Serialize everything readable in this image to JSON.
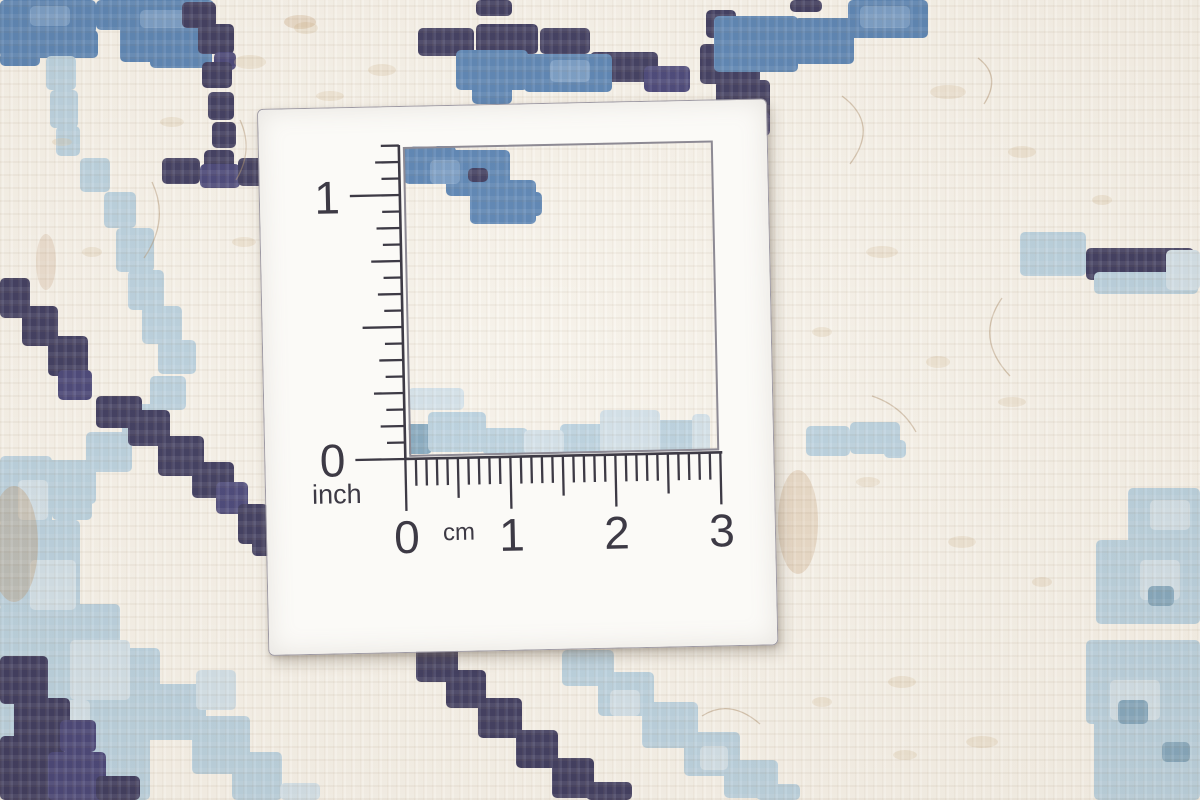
{
  "ruler": {
    "inch": {
      "one": "1",
      "zero": "0",
      "unit": "inch"
    },
    "cm": {
      "zero": "0",
      "one": "1",
      "two": "2",
      "three": "3",
      "unit": "cm"
    }
  },
  "colors": {
    "navy": "#2f2d55",
    "navy2": "#3a3870",
    "blue": "#4e7cb1",
    "blue2": "#6f97c4",
    "pale": "#b6d0e0",
    "pale2": "#d0e0ea",
    "slate": "#7ca3bc",
    "cream": "#f8f4ec",
    "fleck": "#d8c19e",
    "ink": "#3d3a45",
    "card": "#fbfaf7",
    "card_edge": "#9d99a3"
  }
}
